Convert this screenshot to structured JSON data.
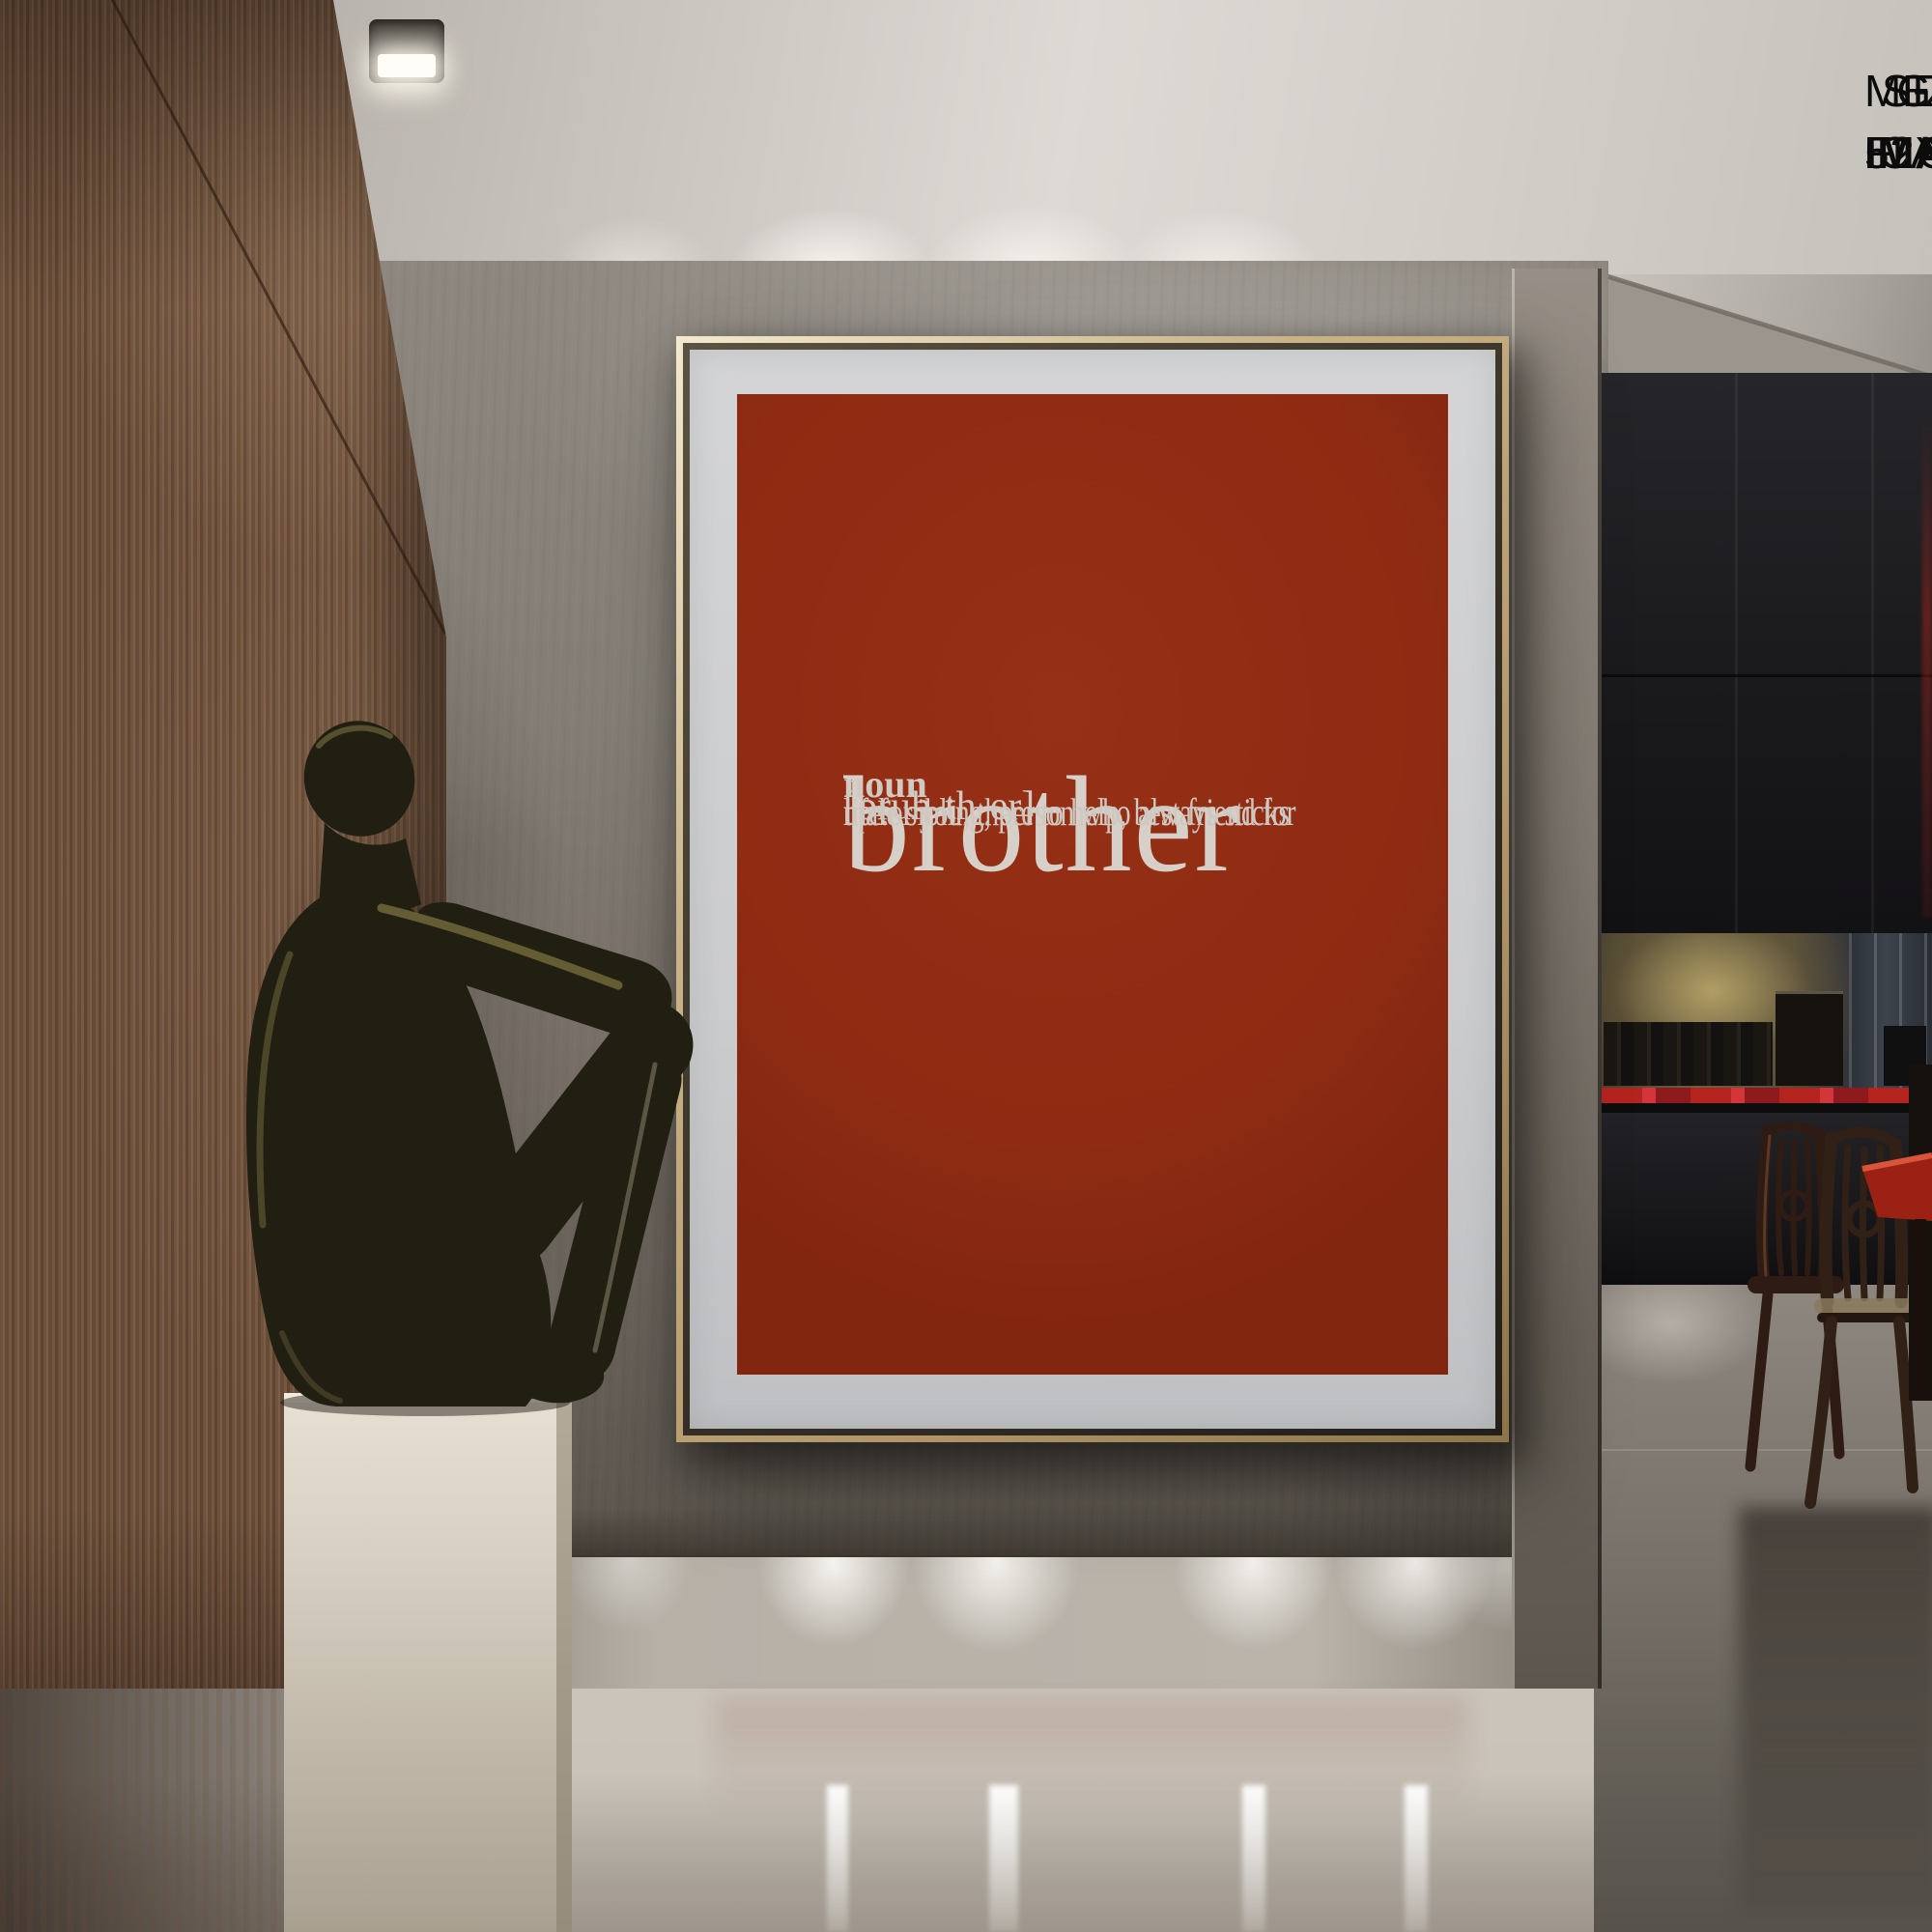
{
  "annotation": {
    "heading": "IN IMAGE:",
    "lines": [
      "SIZE: 52X70 IN",
      "MEDIUM: CANVAS",
      "GOLDEN FLOATING FRAME"
    ]
  },
  "poster": {
    "word": "brother",
    "pronunciation": "[bruh-th-er]",
    "part_of_speech": "noun",
    "definition_lines": [
      "male sibling, person who always sticks",
      "up for you, there to help, best friend for",
      "life."
    ]
  },
  "colors": {
    "poster_background": "#8E2B12",
    "poster_text": "#D6D0C9",
    "mat": "#CBCCCE",
    "frame_gold": "#C8B286",
    "frame_gap": "#352F26",
    "annotation_text": "#0C0C0C",
    "counter_red": "#B5231F",
    "table_red": "#9A2114",
    "wall_mid": "#7C766F",
    "wood_base": "#6B4F3C",
    "ceiling_light": "#D8D3CD",
    "floor_light": "#C9C3BA",
    "pedestal": "#D8D0C3",
    "bronze": "#211E12"
  }
}
